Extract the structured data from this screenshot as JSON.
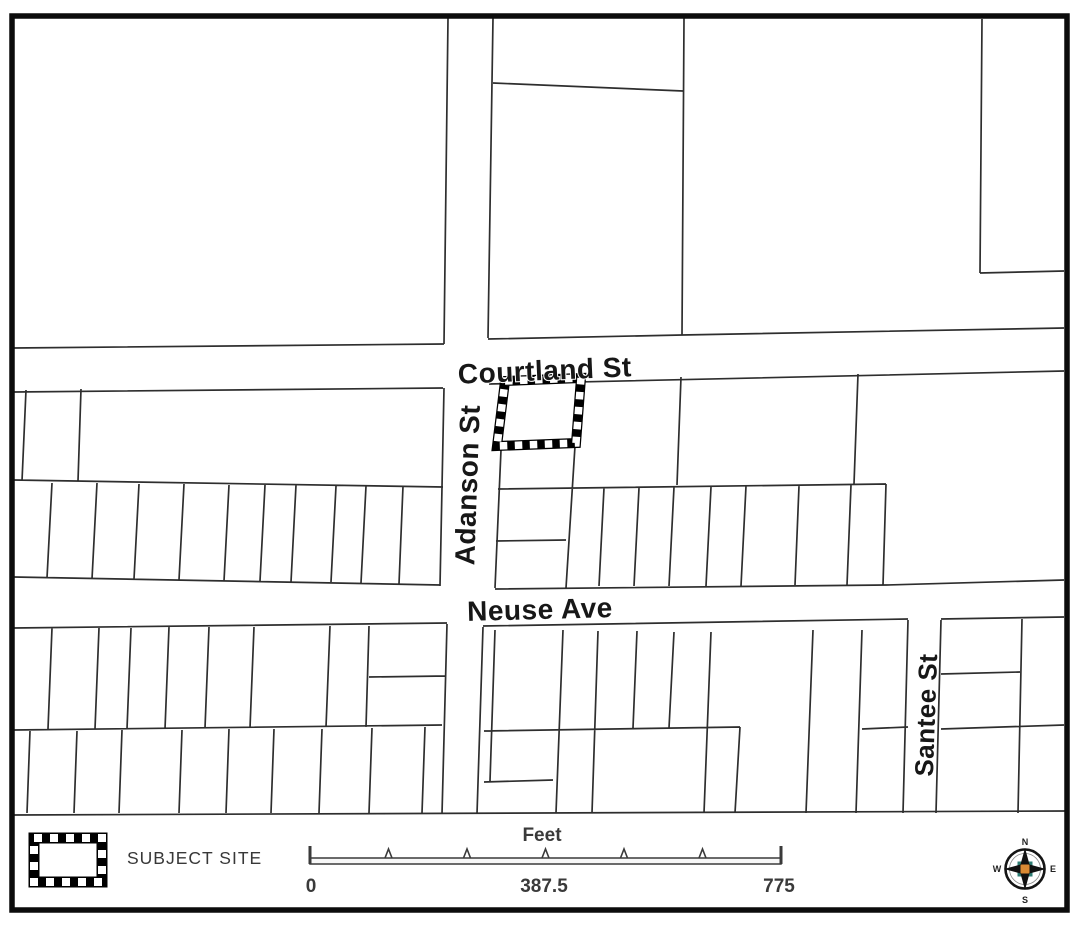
{
  "map": {
    "streets": {
      "courtland": "Courtland St",
      "adanson": "Adanson St",
      "neuse": "Neuse Ave",
      "santee": "Santee St"
    }
  },
  "legend": {
    "subject_site_label": "SUBJECT SITE"
  },
  "scale_bar": {
    "title": "Feet",
    "min": "0",
    "mid": "387.5",
    "max": "775"
  },
  "compass": {
    "north": "N",
    "east": "E",
    "south": "S",
    "west": "W"
  },
  "colors": {
    "line": "#2e2e2e",
    "border": "#0c0c0c",
    "label_text": "#171717",
    "muted_text": "#3a3a3a",
    "compass_orange": "#d98a33",
    "compass_teal": "#2e7d74"
  }
}
